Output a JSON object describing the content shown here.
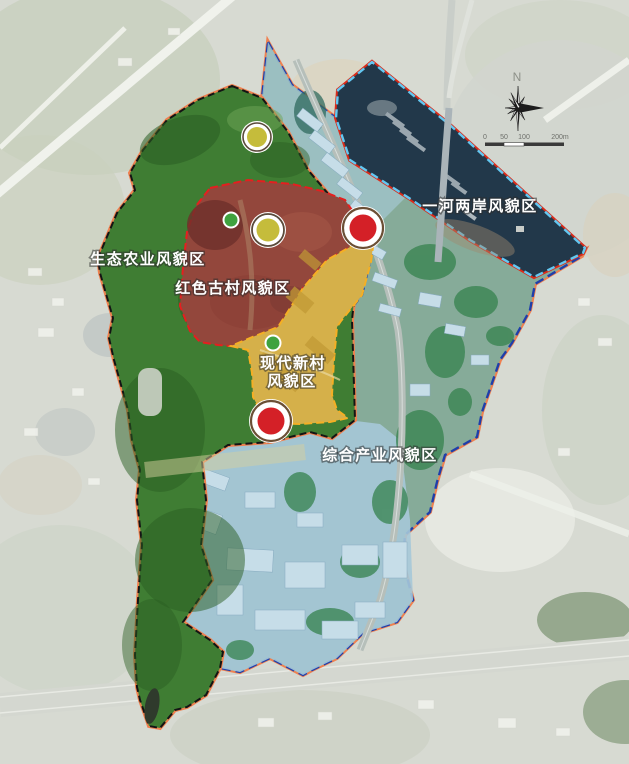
{
  "map": {
    "region_labels": {
      "eco": "生态农业风貌区",
      "ancient_village": "红色古村风貌区",
      "new_village_line1": "现代新村",
      "new_village_line2": "风貌区",
      "industry": "综合产业风貌区",
      "river": "一河两岸风貌区"
    },
    "zone_colors": {
      "eco_green": "#3f7d33",
      "ancient_red": "#93473c",
      "new_village_yellow": "#d5b04a",
      "industry_teal": "#86ab99",
      "industry_blue": "#a6c8d8",
      "river_navy": "#22384a"
    },
    "marker_colors": {
      "major_red": "#d42027",
      "minor_yellow": "#c5bc3b",
      "dot_green": "#3fa23f"
    },
    "compass": {
      "north_label": "N"
    },
    "scalebar": {
      "tick0": "0",
      "tick50": "50",
      "tick100": "100",
      "tick200": "200m"
    }
  }
}
